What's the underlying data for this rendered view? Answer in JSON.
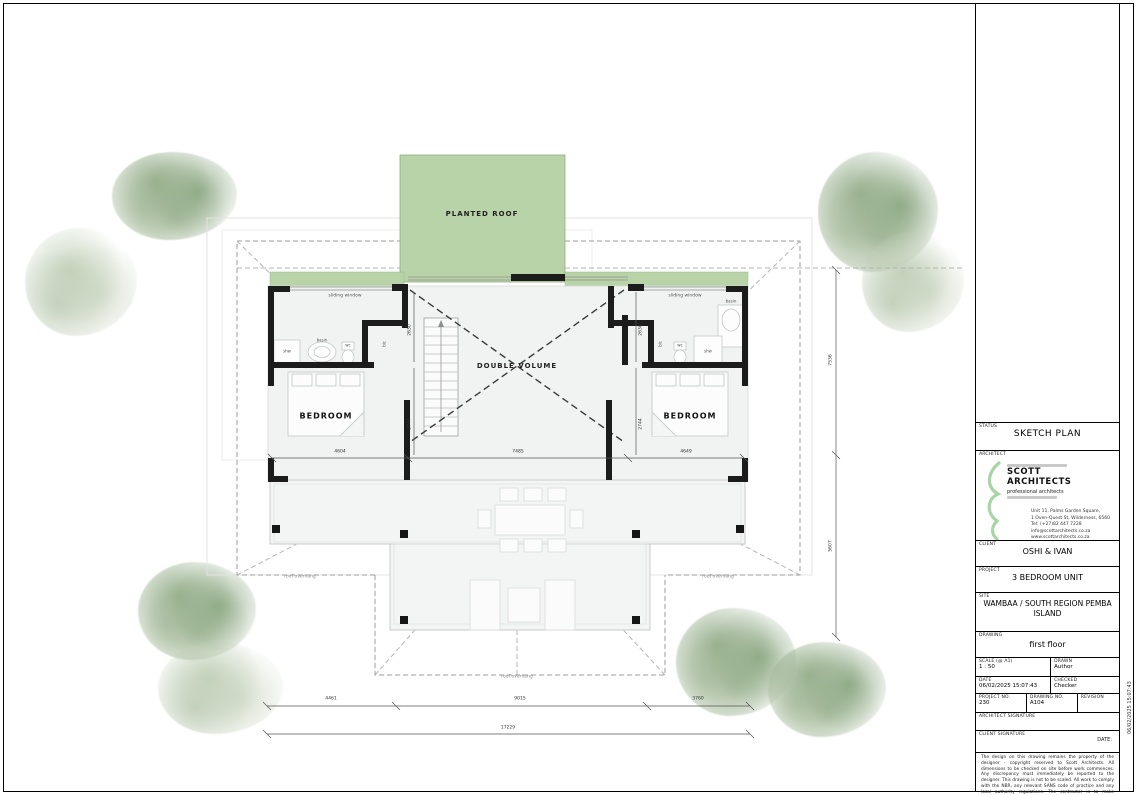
{
  "plan": {
    "labels": {
      "planted_roof": "PLANTED ROOF",
      "double_volume": "DOUBLE VOLUME",
      "bedroom": "BEDROOM",
      "sliding_window": "sliding window",
      "roof_overhang": "roof overhang",
      "shower": "shw",
      "basin": "basin",
      "wc": "wc",
      "bic": "bic"
    },
    "dimensions": {
      "bottom_segments": [
        "4461",
        "9015",
        "3760"
      ],
      "bottom_total": "17229",
      "right_upper": "7536",
      "right_lower": "5607",
      "internal": [
        "4604",
        "7485",
        "4649"
      ],
      "wall_height": "2630",
      "wall_depth": "2744"
    }
  },
  "title_block": {
    "status_label": "STATUS",
    "status_value": "SKETCH PLAN",
    "architect_label": "ARCHITECT",
    "firm": {
      "name_line1": "SCOTT",
      "name_line2": "ARCHITECTS",
      "subtitle": "professional architects",
      "address_line1": "Unit 11, Palms Garden Square,",
      "address_line2": "1 Oven-Quest St, Wilderness, 6560",
      "address_line3": "Tel: (+27)82 447 7228",
      "address_line4": "info@scottarchitects.co.za",
      "address_line5": "www.scottarchitects.co.za"
    },
    "client_label": "CLIENT",
    "client_value": "OSHI & IVAN",
    "project_label": "PROJECT",
    "project_value": "3 BEDROOM UNIT",
    "site_label": "SITE",
    "site_value": "WAMBAA / SOUTH REGION PEMBA ISLAND",
    "drawing_label": "DRAWING",
    "drawing_value": "first floor",
    "scale_label": "SCALE (@ A1)",
    "scale_value": "1 : 50",
    "drawn_label": "DRAWN",
    "drawn_value": "Author",
    "date_label": "DATE",
    "date_value": "06/02/2025 15:07:43",
    "checked_label": "CHECKED",
    "checked_value": "Checker",
    "project_no_label": "PROJECT NO.",
    "project_no_value": "230",
    "drawing_no_label": "DRAWING NO.",
    "drawing_no_value": "A104",
    "revision_label": "REVISION",
    "revision_value": "",
    "architect_signature_label": "ARCHITECT SIGNATURE",
    "client_signature_label": "CLIENT SIGNATURE",
    "signature_date_label": "DATE:",
    "disclaimer": "The design on this drawing remains the property of the designer - copyright reserved to Scott Architects. All dimensions to be checked on site before work commences. Any discrepancy must immediately be reported to the designer. This drawing is not to be scaled. All work to comply with the NBR, any relevant SANS code of practice and any local authority regulations. The contractor is to make themselves aware of these prior to commencement of work.",
    "side_timestamp": "06/02/2025 15:07:43"
  },
  "colors": {
    "planted_roof_green": "#b9d3a8",
    "wall_black": "#1c1c1c",
    "logo_green": "#a8d4a6",
    "tree_dark": "#9cb591",
    "tree_light": "#c9d7c1"
  }
}
